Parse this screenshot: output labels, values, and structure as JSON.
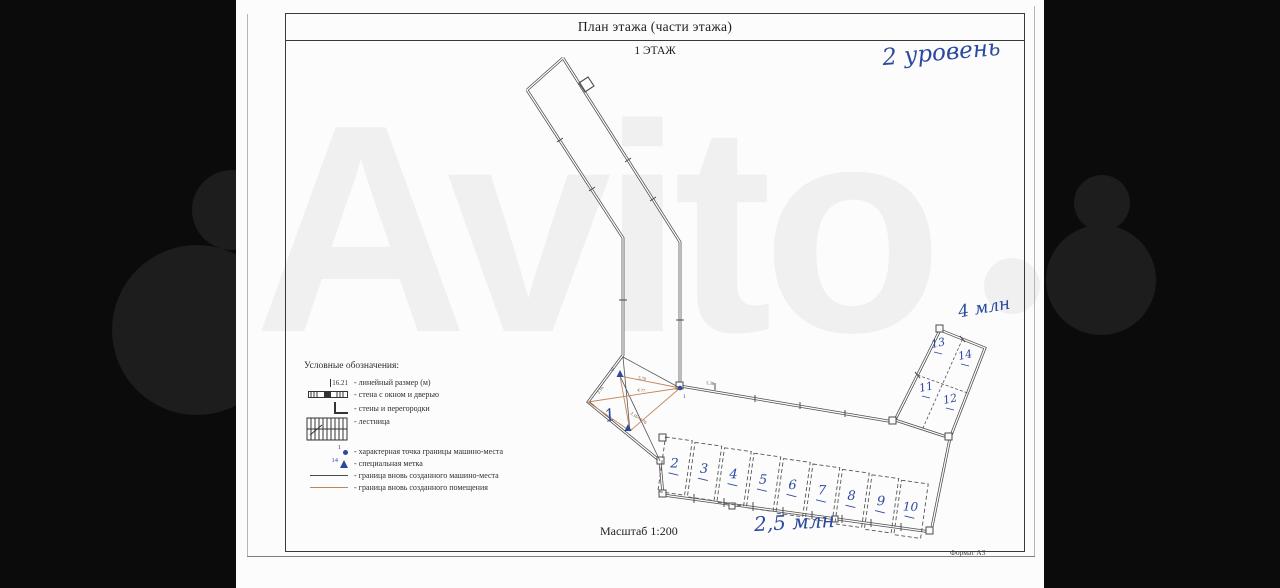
{
  "page": {
    "title": "План этажа (части этажа)",
    "floor_label": "1 ЭТАЖ",
    "scale_label": "Масштаб 1:200",
    "format_label": "Формат А3"
  },
  "watermark": {
    "text": "Avito"
  },
  "handwritten": {
    "level": "2 уровень",
    "price_block": "4 млн",
    "price_row": "2,5 млн"
  },
  "legend": {
    "header": "Условные обозначения:",
    "linear_dim_value": "16.21",
    "items": [
      {
        "icon": "linear-dimension-icon",
        "label": "-  линейный размер (м)"
      },
      {
        "icon": "wall-window-door-icon",
        "label": "-  стена с окном и дверью"
      },
      {
        "icon": "walls-partitions-icon",
        "label": "-  стены и перегородки"
      },
      {
        "icon": "stairs-icon",
        "label": "-  лестница"
      },
      {
        "icon": "boundary-point-icon",
        "point_number": "1",
        "label": "-  характерная точка границы машино-места"
      },
      {
        "icon": "special-mark-icon",
        "point_number": "14",
        "label": "-  специальная метка"
      },
      {
        "icon": "new-parking-boundary-line-icon",
        "label": "-  граница вновь созданного машино-места"
      },
      {
        "icon": "new-room-boundary-line-icon",
        "label": "-  граница вновь созданного помещения"
      }
    ]
  },
  "plan": {
    "spaces": [
      {
        "label": "1"
      },
      {
        "label": "2"
      },
      {
        "label": "3"
      },
      {
        "label": "4"
      },
      {
        "label": "5"
      },
      {
        "label": "6"
      },
      {
        "label": "7"
      },
      {
        "label": "8"
      },
      {
        "label": "9"
      },
      {
        "label": "10"
      },
      {
        "label": "11"
      },
      {
        "label": "12"
      },
      {
        "label": "13"
      },
      {
        "label": "14"
      }
    ],
    "point_markers": [
      {
        "label": "1"
      },
      {
        "label": "2"
      }
    ],
    "dimensions": [
      {
        "label": "5.70"
      },
      {
        "label": "4.77"
      },
      {
        "label": "2.16"
      },
      {
        "label": "2.16+4.76"
      },
      {
        "label": "5.38"
      }
    ]
  },
  "colors": {
    "ink_blue": "#2b4a9e",
    "boundary_orange": "#c4845a",
    "wall_gray": "#4b4b4b",
    "background_black": "#0b0b0b"
  }
}
